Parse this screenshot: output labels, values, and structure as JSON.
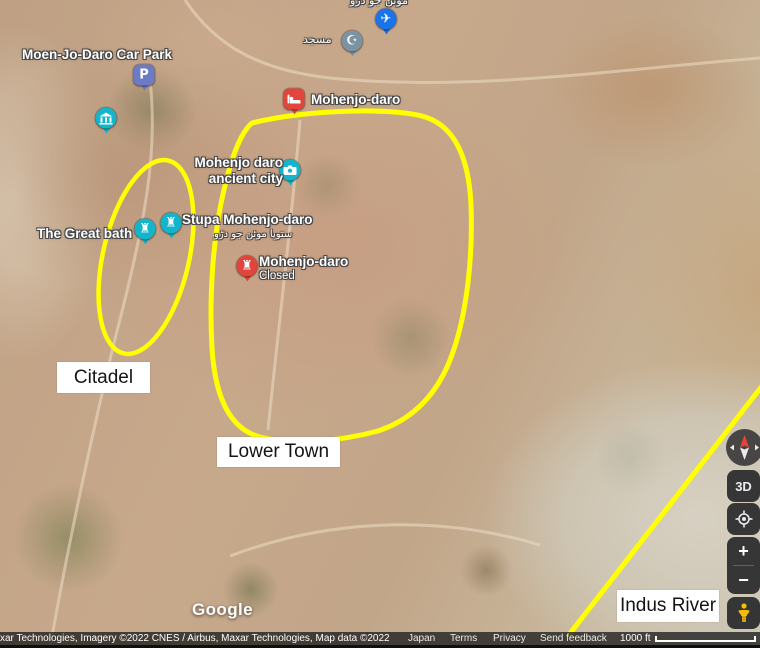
{
  "annotation_color": "#ffff00",
  "labels": {
    "car_park": "Moen-Jo-Daro Car Park",
    "mosque_ar": "مسجد",
    "airport_urdu_partial": "موئن جو دڑو",
    "lodging": "Mohenjo-daro",
    "ancient_city_line1": "Mohenjo daro",
    "ancient_city_line2": "ancient city",
    "stupa": "Stupa Mohenjo-daro",
    "stupa_urdu": "ستوپا موئن جو دڑو",
    "great_bath": "The Great bath",
    "closed_name": "Mohenjo-daro",
    "closed_status": "Closed"
  },
  "callouts": {
    "citadel": "Citadel",
    "lower_town": "Lower Town",
    "indus_river": "Indus River"
  },
  "glyphs": {
    "parking": "P",
    "rook": "♜",
    "plane": "✈",
    "crescent": "☪",
    "three_d": "3D",
    "zoom_in": "+",
    "zoom_out": "−"
  },
  "pin_colors": {
    "teal": "#12b5cb",
    "red": "#e1453b",
    "indigo": "#6d7ac5",
    "slate": "#7b93a3",
    "blue": "#1a73e8",
    "pegman_orange": "#fbbc04"
  },
  "footer": {
    "logo": "Google",
    "attribution": "xar Technologies, Imagery ©2022 CNES / Airbus, Maxar Technologies, Map data ©2022",
    "links": [
      "Japan",
      "Terms",
      "Privacy",
      "Send feedback"
    ],
    "scale_label": "1000 ft"
  }
}
